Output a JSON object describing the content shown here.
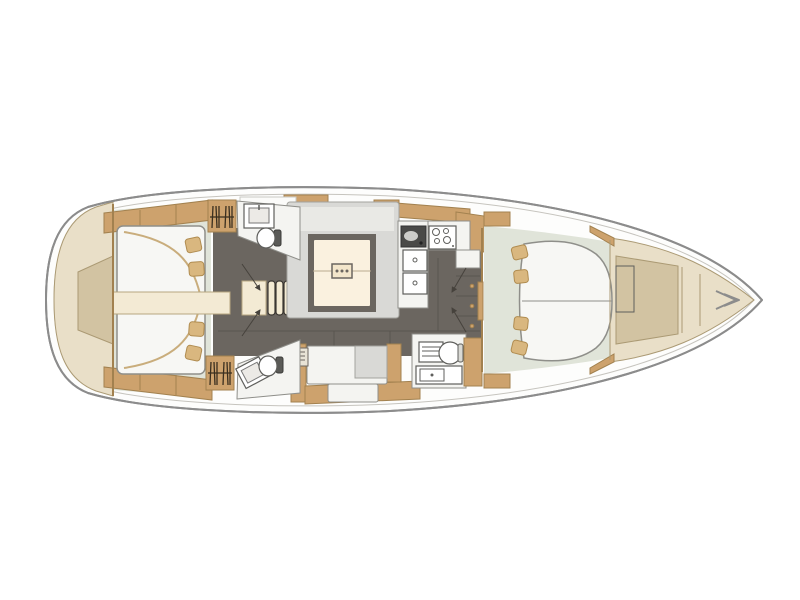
{
  "diagram": {
    "type": "yacht-interior-floor-plan",
    "orientation": "bow-right-stern-left",
    "rooms": [
      "stern-swim-platform",
      "aft-cabin-starboard",
      "aft-cabin-port",
      "aft-head-starboard",
      "aft-head-port",
      "saloon",
      "galley",
      "navigation-station",
      "forward-owner-cabin",
      "bow-anchor-locker"
    ],
    "features": [
      "companionway-steps",
      "saloon-table",
      "u-shaped-sofa",
      "lounge-sofa",
      "double-sink",
      "stove-with-burners",
      "fridge-boxes",
      "chart-table",
      "swivel-chair",
      "toilets",
      "wash-basins",
      "hanging-lockers",
      "island-double-berth",
      "aft-double-berths",
      "door-swing-arrows"
    ]
  },
  "colors": {
    "hull_stroke": "#8c8c8c",
    "hull_inner": "#c6c4be",
    "deck": "#e9dfc8",
    "deck_dark": "#d2c3a2",
    "deck_edge": "#ab9a74",
    "wood": "#cda26d",
    "wood_dark": "#a2814f",
    "wood_light": "#e2c79b",
    "pillow": "#d9b77f",
    "pillow_edge": "#b08c50",
    "floor": "#6b6660",
    "floor_seam": "#59554f",
    "floor_pale": "#e0e4d9",
    "sofa": "#d9d9d6",
    "sofa_light": "#e9e9e5",
    "sofa_edge": "#a3a39e",
    "white": "#f4f4f1",
    "fixture_edge": "#5f5f5c",
    "table": "#faf1df",
    "table_edge": "#6b6660",
    "cream": "#f3ead4",
    "cream_edge": "#b7a77f",
    "glyph": "#3a2f1f",
    "arrow": "#46423c"
  }
}
